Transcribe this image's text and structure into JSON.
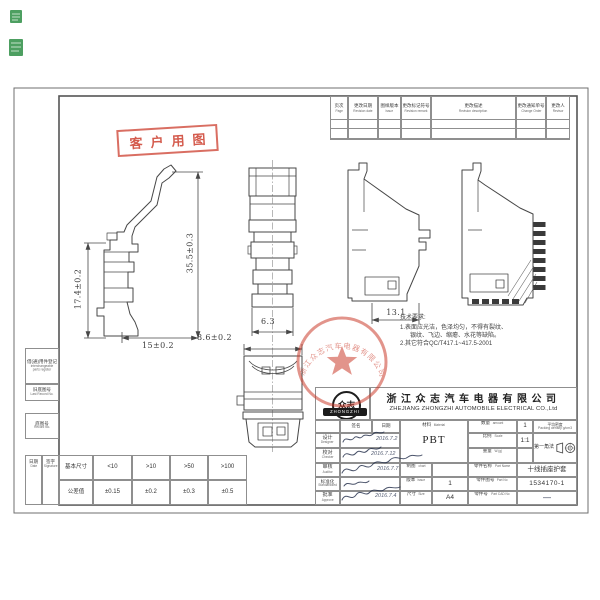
{
  "palette": {
    "paper": "#ffffff",
    "drawing_line": "#474747",
    "table_line": "#8f8f8f",
    "stamp_red": "#cc3e2e",
    "ink_blue": "#2a3550",
    "seal_green": "#2f8f46"
  },
  "customer_stamp": {
    "label": "客户用图"
  },
  "revision_table": {
    "columns": [
      {
        "zh": "页次",
        "en": "Page"
      },
      {
        "zh": "更改日期",
        "en": "Revision date"
      },
      {
        "zh": "图样版本",
        "en": "Issue"
      },
      {
        "zh": "更改标记符号",
        "en": "Revision remark"
      },
      {
        "zh": "更改描述",
        "en": "Revision description"
      },
      {
        "zh": "更改通知单号",
        "en": "Change Order"
      },
      {
        "zh": "更改人",
        "en": "Revisor"
      }
    ]
  },
  "margin": {
    "block1": {
      "zh": "借(通)用件登记",
      "en": "interchangeable parts register"
    },
    "block2": {
      "zh": "旧底图号",
      "en": "Last Record No."
    },
    "block3": {
      "zh": "底图号",
      "en": "Record No."
    },
    "date": {
      "zh": "日期",
      "en": "Date"
    },
    "sign": {
      "zh": "签字",
      "en": "Signature"
    }
  },
  "tolerance_table": {
    "row1": [
      "基本尺寸",
      "<10",
      ">10",
      ">50",
      ">100"
    ],
    "row2": [
      "公差值",
      "±0.15",
      "±0.2",
      "±0.3",
      "±0.5"
    ]
  },
  "dims": {
    "total_height": "35.5±0.3",
    "sub_height": "17.4±0.2",
    "base_width": "15±0.2",
    "outer_width": "8.6±0.2",
    "inner_width": "6.3",
    "depth": "13.1"
  },
  "tech_req": {
    "title": "技术要求:",
    "line1": "1.表面应光洁，色泽均匀，不得有裂纹、",
    "line2": "银纹、飞边、缩瘪、水花等缺陷。",
    "line3": "2.其它符合QC/T417.1~417.5-2001"
  },
  "seal": {
    "arc_text": "浙江众志汽车电器有限公司"
  },
  "title_block": {
    "company_zh": "浙江众志汽车电器有限公司",
    "company_en": "ZHEJIANG ZHONGZHI AUTOMOBILE ELECTRICAL CO.,Ltd",
    "logo_zh": "众志",
    "logo_en": "ZHONGZHI",
    "sign_header": "签名",
    "date_header": "日期",
    "roles": [
      {
        "zh": "设计",
        "en": "Designer"
      },
      {
        "zh": "校对",
        "en": "Checker"
      },
      {
        "zh": "审核",
        "en": "Auditor"
      },
      {
        "zh": "标准化",
        "en": "Standardized"
      },
      {
        "zh": "批准",
        "en": "Approve"
      }
    ],
    "sig_dates": [
      "2016.7.2",
      "2016.7.12",
      "2016.7.7",
      "2016.7.4"
    ],
    "material": {
      "zh": "材料",
      "en": "Material",
      "value": "PBT"
    },
    "amount": {
      "zh": "数量",
      "en": "amount",
      "value": "1"
    },
    "density": {
      "zh": "平均密度",
      "en": "Packing density g/cm3"
    },
    "scale": {
      "zh": "比例",
      "en": "Scale",
      "value": "1:1"
    },
    "projection": {
      "label": "第一角法"
    },
    "weight": {
      "zh": "重量",
      "en": "W.(g)",
      "value": ""
    },
    "chart": {
      "zh": "制图",
      "en": "chart",
      "value": ""
    },
    "issue": {
      "zh": "版本",
      "en": "Issue",
      "value": "1"
    },
    "size": {
      "zh": "尺寸",
      "en": "Size",
      "value": "A4"
    },
    "part_name": {
      "zh": "零件名称",
      "en": "Part Name",
      "value": "十线插座护套"
    },
    "part_no": {
      "zh": "零件图号",
      "en": "Part No",
      "value": "1534170-1"
    },
    "cad_no": {
      "zh": "零件号",
      "en": "Part CAD No",
      "value": "—"
    }
  }
}
